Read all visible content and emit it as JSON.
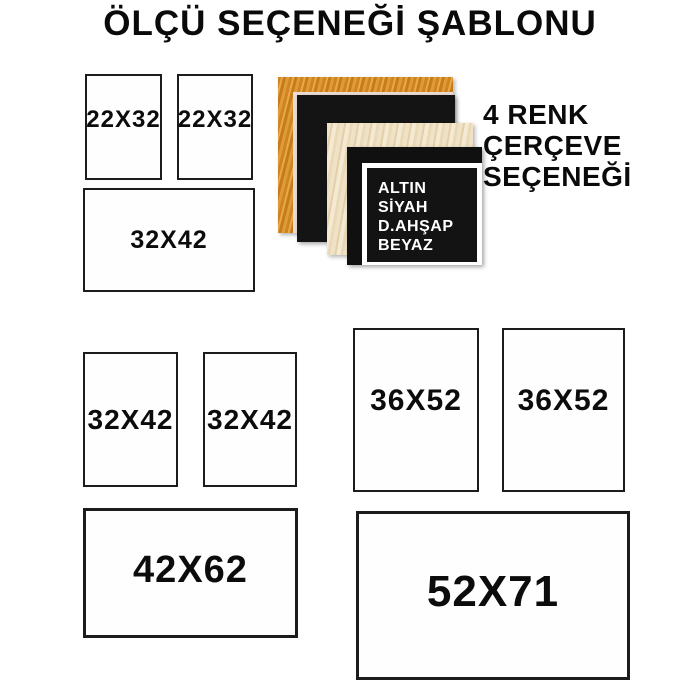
{
  "title": "ÖLÇÜ SEÇENEĞİ ŞABLONU",
  "sizes": [
    "22X32",
    "22X32",
    "32X42",
    "32X42",
    "32X42",
    "36X52",
    "36X52",
    "42X62",
    "52X71"
  ],
  "frame_options": {
    "heading_lines": [
      "4 RENK",
      "ÇERÇEVE",
      "SEÇENEĞİ"
    ],
    "color_list": [
      "ALTIN",
      "SİYAH",
      "D.AHŞAP",
      "BEYAZ"
    ],
    "colors": {
      "altin": "#D9922F",
      "siyah": "#141414",
      "dogal_ahsap": "#EDDCBA",
      "beyaz": "#FFFFFF"
    }
  },
  "background": "#FFFFFF",
  "text_color": "#0A0A0A"
}
